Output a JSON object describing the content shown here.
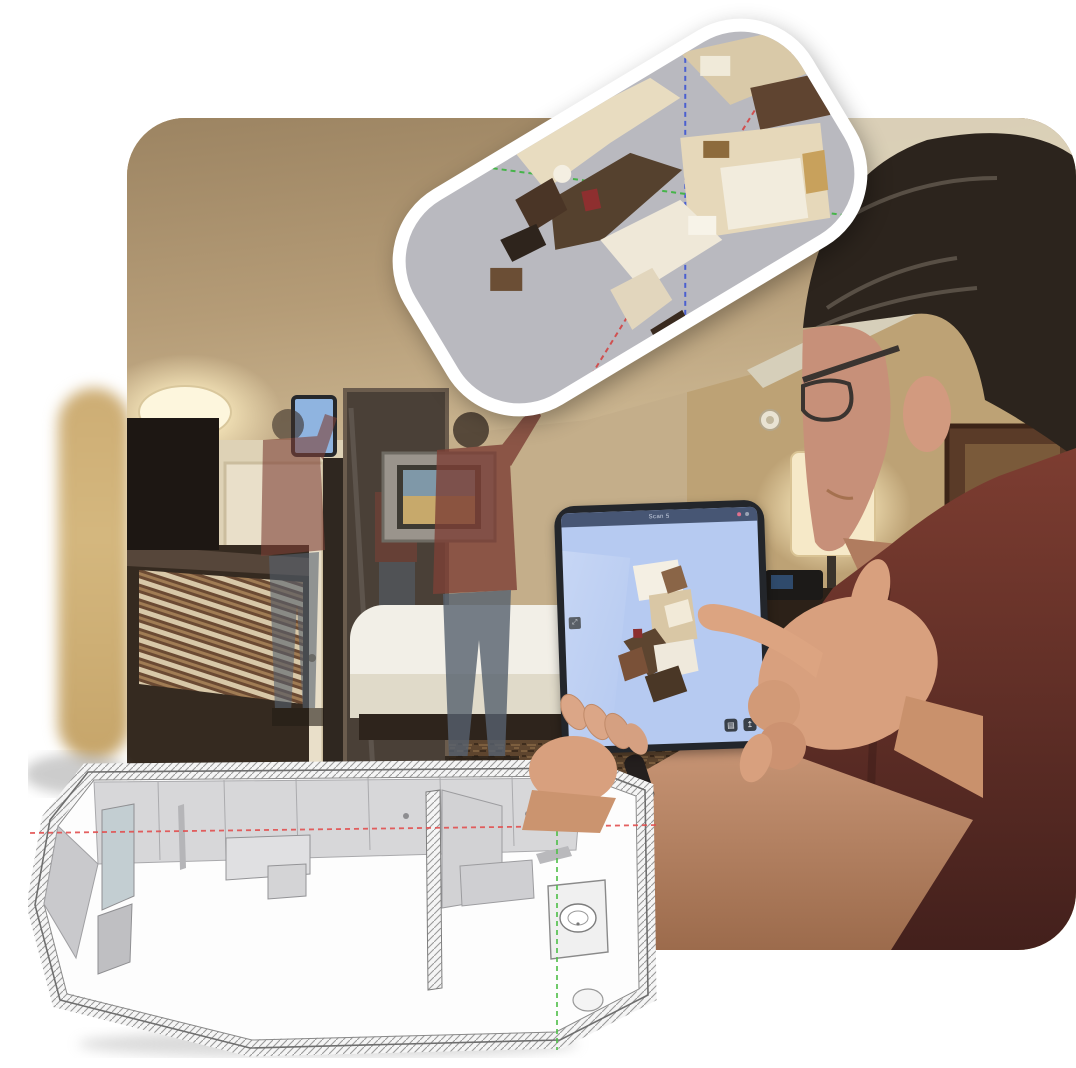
{
  "tablet": {
    "title": "Scan 5",
    "topbar_color": "#475674",
    "screen_color": "#b6caf1",
    "record_dot_color": "#e0718e",
    "status_dot_color": "#9aa3b5",
    "side_button_glyph": "⤢",
    "page_button_glyph": "▤",
    "export_button_glyph": "↥"
  },
  "scan_card": {
    "background": "#b9b9bf",
    "border_color": "#ffffff",
    "axis_colors": {
      "x_red": "#d05050",
      "y_green": "#46b44a",
      "z_blue": "#4a5fd0"
    }
  },
  "cad_model": {
    "floor_color": "#fdfdfd",
    "wall_panel_color": "#d7d7d9",
    "axis_colors": {
      "red": "#e25050",
      "green": "#4fbf49"
    }
  },
  "photo": {
    "wall_color": "#c4ae8a",
    "shirt_color": "#76362c",
    "jeans_color": "#56616f",
    "carpet_color": "#5e452e",
    "lamp_glow_color": "#f6e9c8"
  }
}
